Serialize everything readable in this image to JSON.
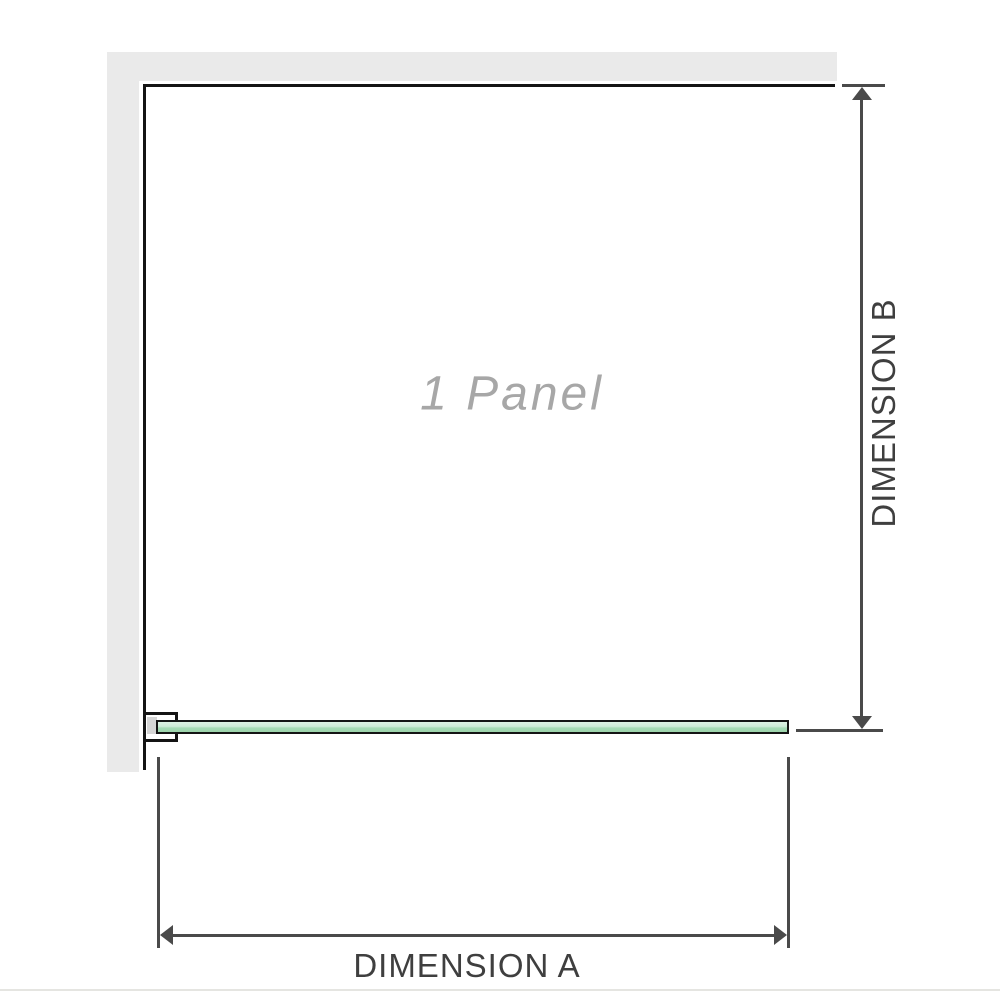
{
  "diagram": {
    "panel_label": "1 Panel",
    "dimension_a_label": "DIMENSION A",
    "dimension_b_label": "DIMENSION B"
  },
  "colors": {
    "background": "#ffffff",
    "wall": "#eaeaea",
    "panel_outline": "#141414",
    "dimension_line": "#4a4a4a",
    "dimension_text": "#3f3f3f",
    "panel_watermark_text": "#a7a7a7",
    "glass_green_light": "#ddf1e3",
    "glass_green_dark": "#9cd4ab",
    "bracket_inner": "#d5d5d5",
    "baseline": "#e5e5e1"
  }
}
